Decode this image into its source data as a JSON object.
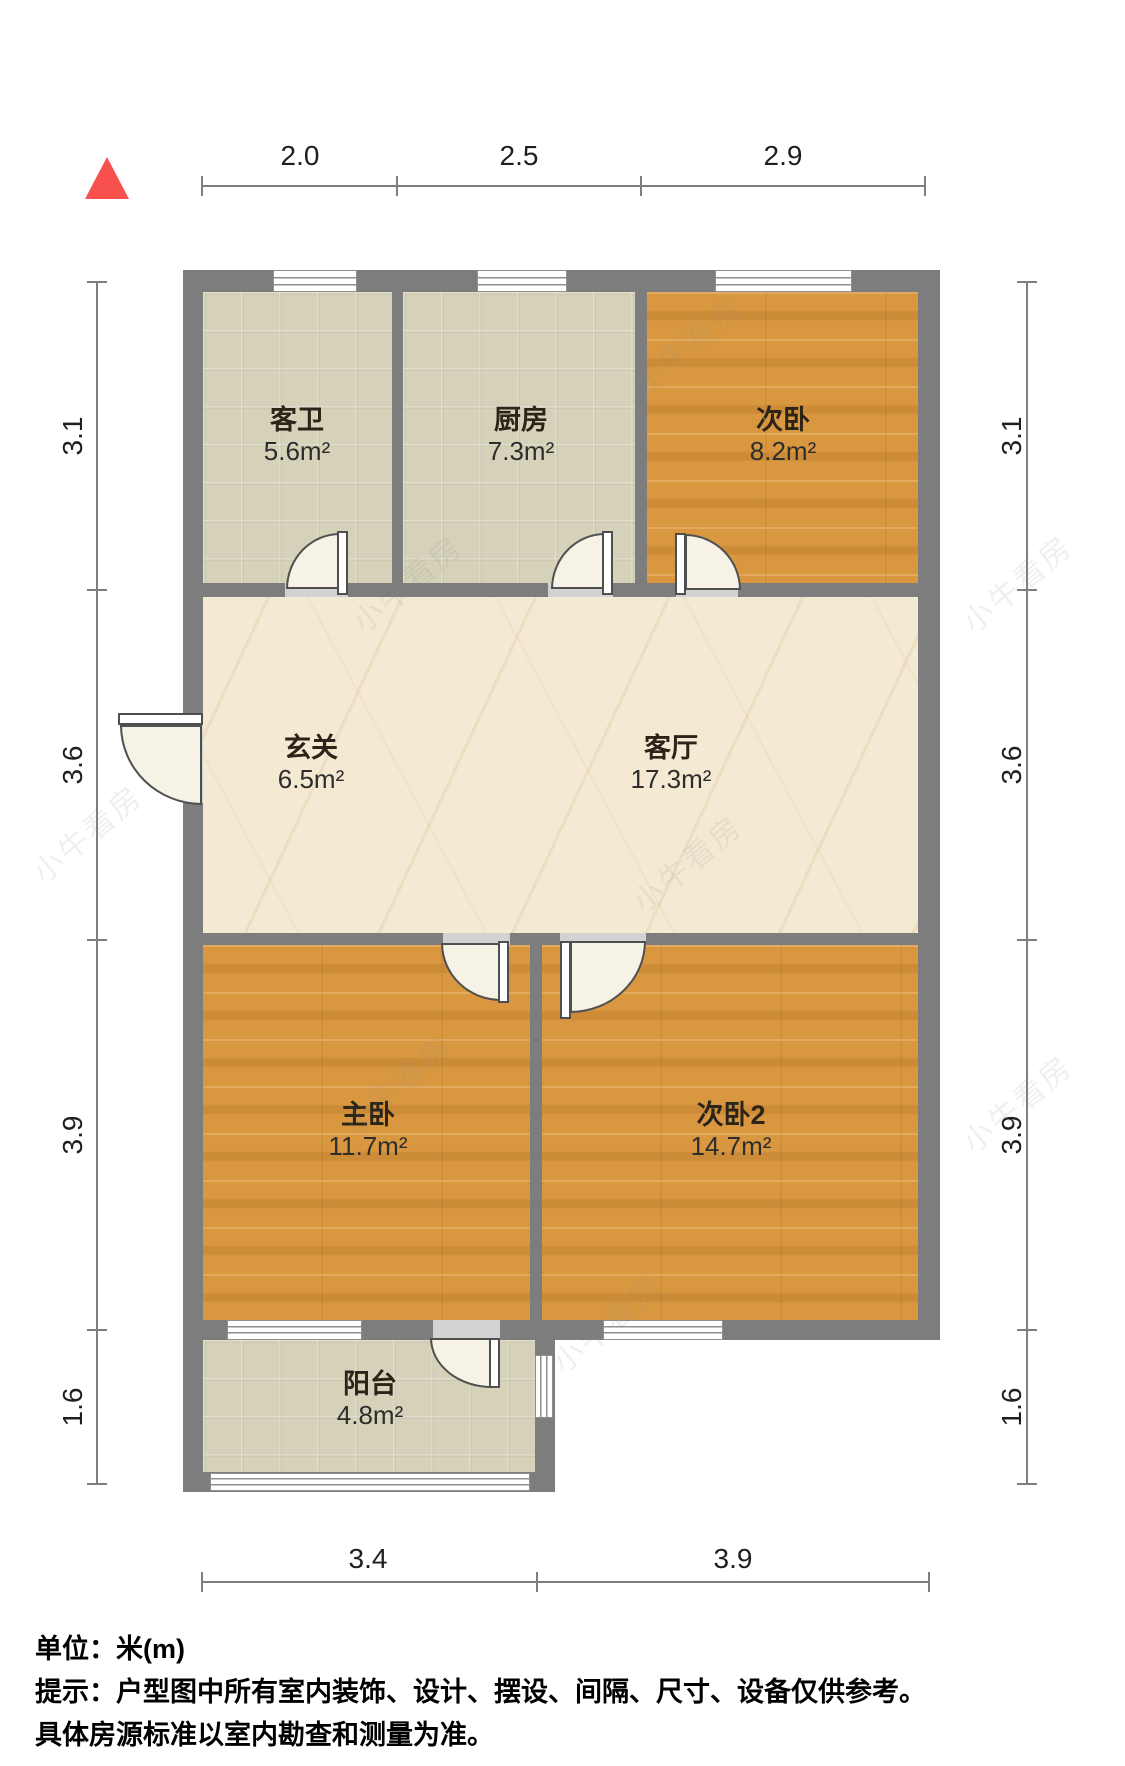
{
  "title": "户型图",
  "north_arrow": {
    "description": "north-indicator-triangle"
  },
  "rooms": [
    {
      "name": "客卫",
      "area": "5.6m²"
    },
    {
      "name": "厨房",
      "area": "7.3m²"
    },
    {
      "name": "次卧",
      "area": "8.2m²"
    },
    {
      "name": "玄关",
      "area": "6.5m²"
    },
    {
      "name": "客厅",
      "area": "17.3m²"
    },
    {
      "name": "主卧",
      "area": "11.7m²"
    },
    {
      "name": "次卧2",
      "area": "14.7m²"
    },
    {
      "name": "阳台",
      "area": "4.8m²"
    }
  ],
  "dimensions": {
    "top": [
      "2.0",
      "2.5",
      "2.9"
    ],
    "bottom": [
      "3.4",
      "3.9"
    ],
    "left": [
      "3.1",
      "3.6",
      "3.9",
      "1.6"
    ],
    "right": [
      "3.1",
      "3.6",
      "3.9",
      "1.6"
    ]
  },
  "footer": {
    "unit_line": "单位：米(m)",
    "tip_line1": "提示：户型图中所有室内装饰、设计、摆设、间隔、尺寸、设备仅供参考。",
    "tip_line2": "具体房源标准以室内勘查和测量为准。"
  },
  "watermark": {
    "text": "小牛看房"
  },
  "colors": {
    "wall": "#7d7d7d",
    "wood": "#d99840",
    "tile": "#d6d2b9",
    "marble": "#f4ead3",
    "accent_red": "#f8504c"
  }
}
